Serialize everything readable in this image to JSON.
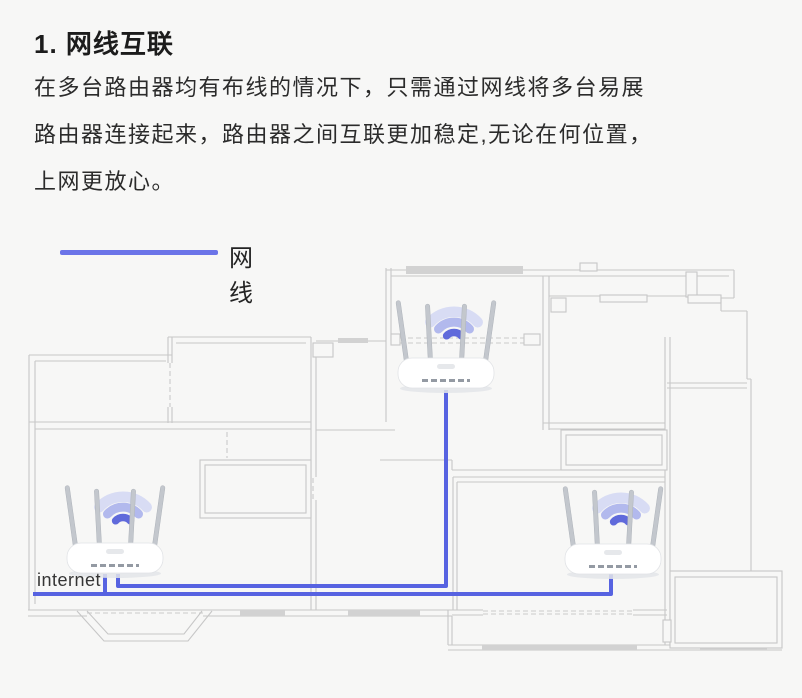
{
  "header": {
    "title": "1. 网线互联",
    "lines": [
      "在多台路由器均有布线的情况下，只需通过网线将多台易展",
      "路由器连接起来，路由器之间互联更加稳定,无论在何位置，",
      "上网更放心。"
    ]
  },
  "legend": {
    "label": "网线"
  },
  "diagram": {
    "type": "floorplan-with-routers",
    "internet_label": "internet",
    "routers": [
      {
        "name": "top-router",
        "x": 446,
        "y": 372
      },
      {
        "name": "internet-router",
        "x": 115,
        "y": 557
      },
      {
        "name": "bottom-right-router",
        "x": 613,
        "y": 558
      }
    ],
    "cables": [
      {
        "name": "cable-top-router-to-internet-router",
        "path": "top router down, left along hallway, up into internet router"
      },
      {
        "name": "cable-internet-feed-to-bottom-right-router",
        "path": "from wall feed at left, right along bottom hallway, up into bottom-right router"
      },
      {
        "name": "cable-internet-router-tap",
        "path": "internet router down to feed line"
      }
    ]
  },
  "colors": {
    "background": "#f7f7f6",
    "text": "#2b2b2b",
    "cable": "#5763e1",
    "legend_line": "#6b74e8",
    "wall": "#c7c7c7",
    "window_fill": "#d2d2d2",
    "wifi_strong": "#4f5ad8",
    "wifi_mid": "#7a86e6",
    "wifi_weak": "#a9b4f2",
    "router_body": "#ffffff",
    "antenna": "#c3c7cd"
  }
}
